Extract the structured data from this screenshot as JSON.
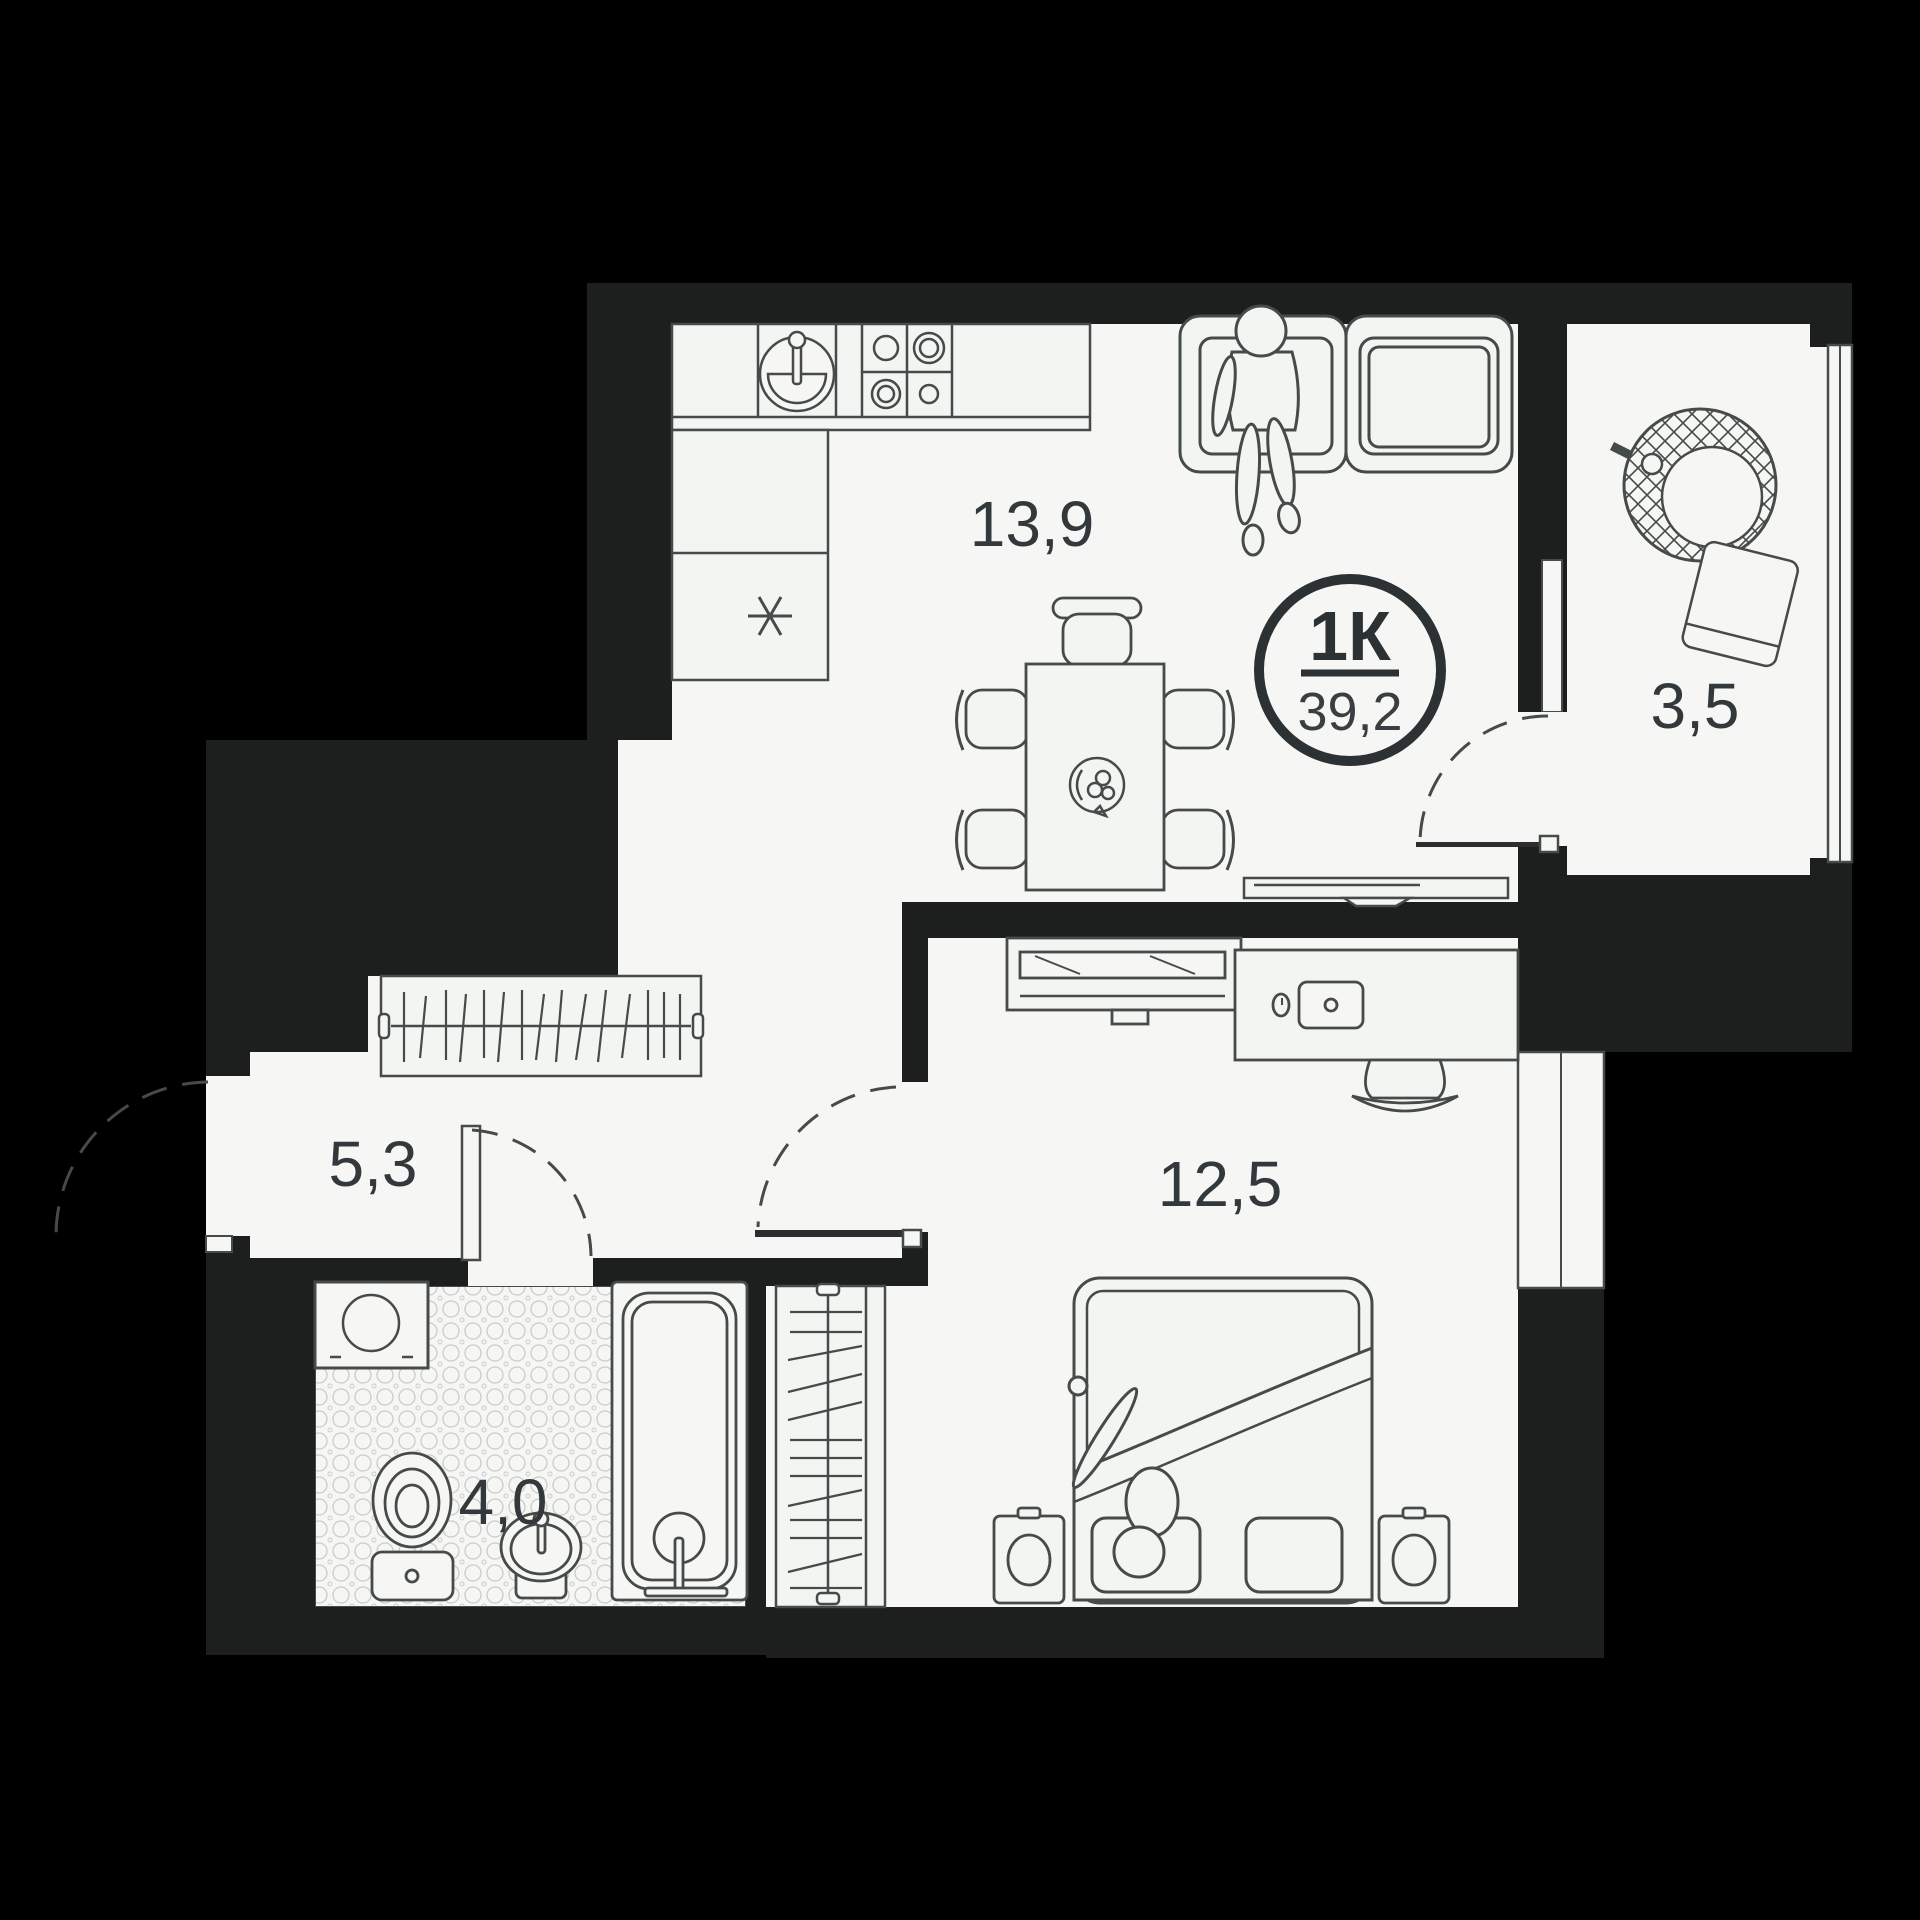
{
  "plan": {
    "type": "apartment-floor-plan",
    "badge": {
      "rooms_label": "1К",
      "total_area": "39,2"
    },
    "rooms": [
      {
        "id": "kitchen-living",
        "area_label": "13,9"
      },
      {
        "id": "balcony",
        "area_label": "3,5"
      },
      {
        "id": "hallway",
        "area_label": "5,3"
      },
      {
        "id": "bathroom",
        "area_label": "4,0"
      },
      {
        "id": "bedroom",
        "area_label": "12,5"
      }
    ],
    "icons": [
      "kitchen-sink-icon",
      "stove-burners-icon",
      "fridge-snowflake-icon",
      "sofa-icon",
      "person-sitting-icon",
      "dining-table-icon",
      "fruit-bowl-icon",
      "chair-icon",
      "tv-icon",
      "hanging-chair-icon",
      "wardrobe-hangers-icon",
      "washing-machine-icon",
      "toilet-icon",
      "sink-icon",
      "bathtub-icon",
      "bed-icon",
      "person-sleeping-icon",
      "nightstand-lamp-icon",
      "desk-icon",
      "laptop-icon",
      "mouse-icon",
      "door-swing-arc-icon",
      "window-icon"
    ],
    "colors": {
      "background": "#000000",
      "wall": "#1d1e1e",
      "floor": "#f6f7f5",
      "line": "#454b48",
      "text": "#32383b",
      "tile": "#c9ccc9"
    }
  }
}
